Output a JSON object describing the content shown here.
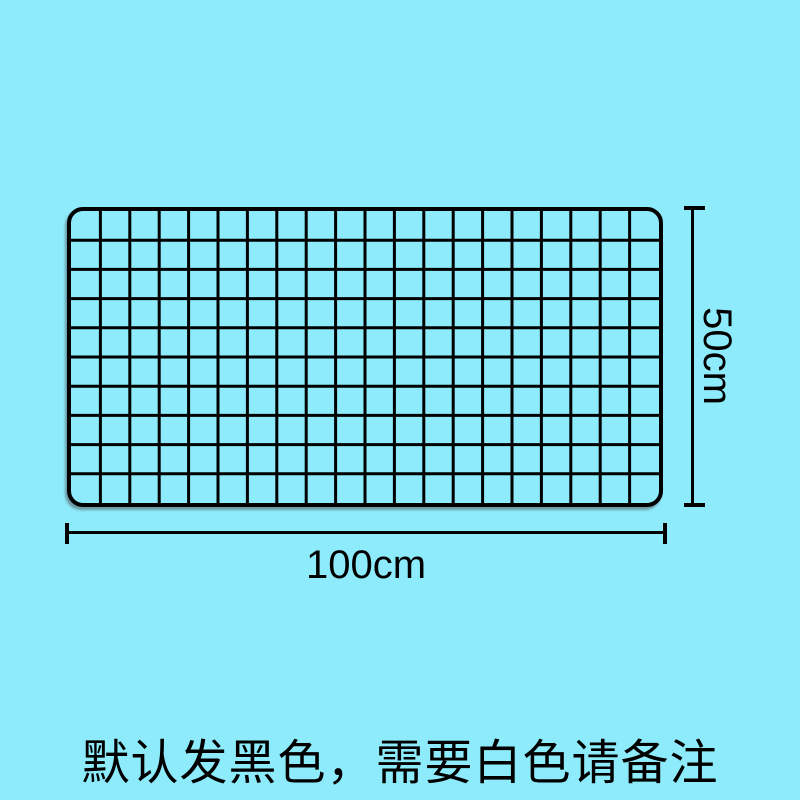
{
  "colors": {
    "background": "#8DEBFB",
    "line": "#000000"
  },
  "grid": {
    "columns": 20,
    "rows": 10
  },
  "dimensions": {
    "height_label": "50cm",
    "width_label": "100cm"
  },
  "note_text": "默认发黑色，需要白色请备注"
}
